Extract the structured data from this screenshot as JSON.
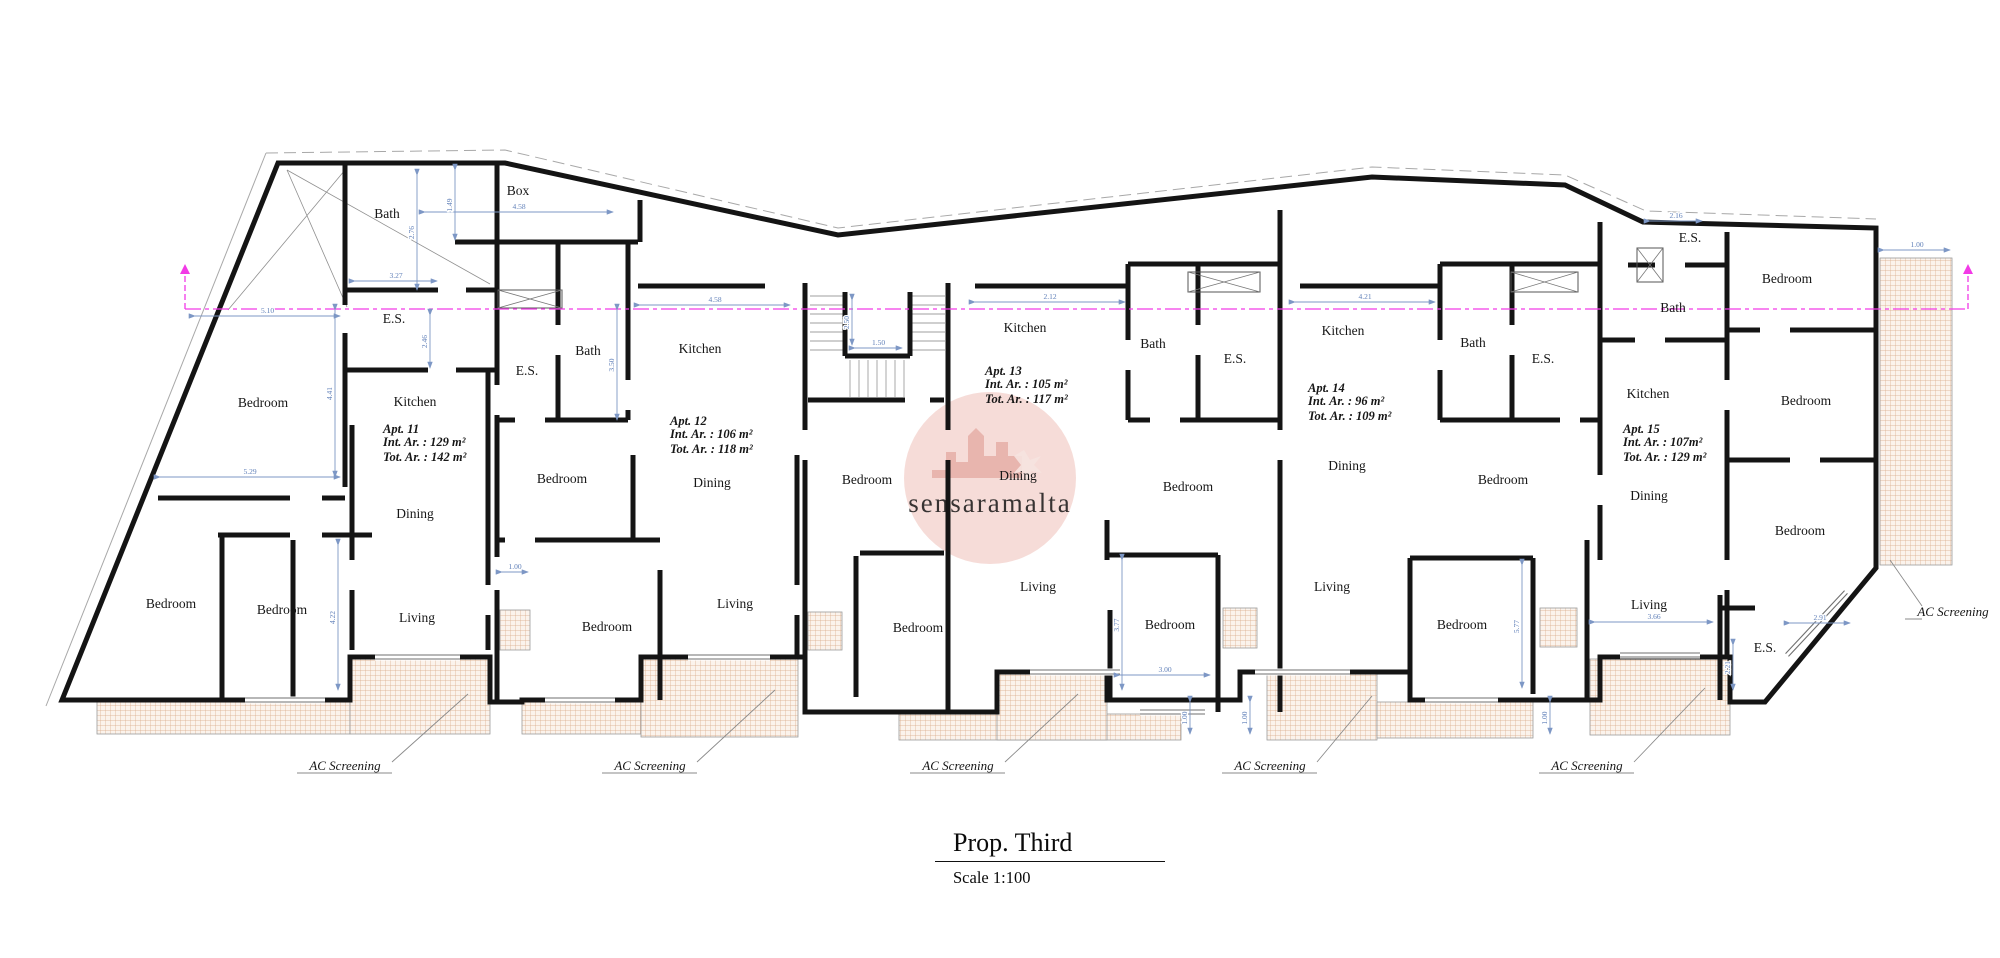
{
  "title": {
    "text": "Prop. Third",
    "scale": "Scale 1:100"
  },
  "watermark": {
    "text": "sensaramalta",
    "cx": 990,
    "cy": 478,
    "r": 86,
    "circle_color": "#f0c6c0",
    "glyph_color": "#e2a49c",
    "text_color": "#d9beb8"
  },
  "colors": {
    "wall": "#141414",
    "thin": "#9a9a9a",
    "boundary": "#a8a8a8",
    "dim": "#7d97c5",
    "dim_text": "#5f7fb8",
    "section": "#f23ae6",
    "hatch_line": "#d9a987",
    "hatch_bg": "#fbf3ec"
  },
  "envelope": "M62,700 L278,163 L505,163 L838,235 L1372,177 L1565,185 L1643,222 L1876,228 L1876,568 L1765,702 L1730,702 L1730,657 L1600,657 L1600,700 L1533,700 L1410,700 L1410,672 L1240,672 L1240,700 L1107,700 L1107,672 L997,672 L997,712 L805,712 L805,657 L641,657 L641,700 L522,700 L522,702 L490,702 L490,657 L350,657 L350,700 L62,700 Z",
  "boundary_solid": [
    [
      46,
      706,
      266,
      153
    ]
  ],
  "boundary_dashed": "M266,153 L505,150 L838,228 L1372,167 L1565,175 L1646,211 L1876,219",
  "cross_brace": [
    [
      287,
      170,
      490,
      284
    ],
    [
      287,
      170,
      347,
      307
    ],
    [
      345,
      170,
      228,
      310
    ]
  ],
  "walls": [
    [
      345,
      163,
      345,
      305
    ],
    [
      345,
      290,
      438,
      290
    ],
    [
      466,
      290,
      497,
      290
    ],
    [
      345,
      333,
      345,
      487
    ],
    [
      345,
      370,
      428,
      370
    ],
    [
      456,
      370,
      497,
      370
    ],
    [
      158,
      498,
      290,
      498
    ],
    [
      322,
      498,
      345,
      498
    ],
    [
      218,
      535,
      290,
      535
    ],
    [
      322,
      535,
      372,
      535
    ],
    [
      222,
      535,
      222,
      700
    ],
    [
      293,
      540,
      293,
      700
    ],
    [
      352,
      425,
      352,
      560
    ],
    [
      352,
      590,
      352,
      650
    ],
    [
      488,
      370,
      488,
      585
    ],
    [
      488,
      615,
      488,
      650
    ],
    [
      497,
      163,
      497,
      385
    ],
    [
      497,
      415,
      497,
      557
    ],
    [
      497,
      590,
      497,
      700
    ],
    [
      455,
      242,
      638,
      242
    ],
    [
      640,
      200,
      640,
      242
    ],
    [
      558,
      242,
      558,
      325
    ],
    [
      558,
      355,
      558,
      420
    ],
    [
      628,
      242,
      628,
      380
    ],
    [
      628,
      410,
      628,
      420
    ],
    [
      497,
      420,
      515,
      420
    ],
    [
      545,
      420,
      628,
      420
    ],
    [
      638,
      286,
      765,
      286
    ],
    [
      497,
      540,
      505,
      540
    ],
    [
      535,
      540,
      660,
      540
    ],
    [
      633,
      455,
      633,
      540
    ],
    [
      660,
      570,
      660,
      700
    ],
    [
      797,
      455,
      797,
      585
    ],
    [
      797,
      615,
      797,
      655
    ],
    [
      805,
      283,
      805,
      430
    ],
    [
      805,
      460,
      805,
      700
    ],
    [
      845,
      292,
      845,
      356
    ],
    [
      845,
      356,
      910,
      356
    ],
    [
      910,
      292,
      910,
      356
    ],
    [
      808,
      400,
      905,
      400
    ],
    [
      930,
      400,
      944,
      400
    ],
    [
      860,
      553,
      944,
      553
    ],
    [
      856,
      556,
      856,
      697
    ],
    [
      948,
      283,
      948,
      430
    ],
    [
      948,
      460,
      948,
      712
    ],
    [
      975,
      286,
      1128,
      286
    ],
    [
      1128,
      264,
      1280,
      264
    ],
    [
      1128,
      264,
      1128,
      340
    ],
    [
      1128,
      370,
      1128,
      420
    ],
    [
      1198,
      264,
      1198,
      325
    ],
    [
      1198,
      355,
      1198,
      420
    ],
    [
      1128,
      420,
      1150,
      420
    ],
    [
      1180,
      420,
      1280,
      420
    ],
    [
      1280,
      210,
      1280,
      430
    ],
    [
      1280,
      460,
      1280,
      712
    ],
    [
      1107,
      520,
      1107,
      560
    ],
    [
      1107,
      555,
      1218,
      555
    ],
    [
      1218,
      555,
      1218,
      712
    ],
    [
      1110,
      610,
      1110,
      700
    ],
    [
      1300,
      286,
      1440,
      286
    ],
    [
      1440,
      264,
      1600,
      264
    ],
    [
      1440,
      264,
      1440,
      340
    ],
    [
      1440,
      370,
      1440,
      420
    ],
    [
      1512,
      264,
      1512,
      325
    ],
    [
      1512,
      355,
      1512,
      420
    ],
    [
      1440,
      420,
      1560,
      420
    ],
    [
      1580,
      420,
      1600,
      420
    ],
    [
      1600,
      222,
      1600,
      475
    ],
    [
      1600,
      505,
      1600,
      560
    ],
    [
      1587,
      540,
      1587,
      700
    ],
    [
      1410,
      558,
      1533,
      558
    ],
    [
      1410,
      558,
      1410,
      694
    ],
    [
      1533,
      558,
      1533,
      694
    ],
    [
      1600,
      340,
      1635,
      340
    ],
    [
      1665,
      340,
      1727,
      340
    ],
    [
      1628,
      265,
      1655,
      265
    ],
    [
      1685,
      265,
      1727,
      265
    ],
    [
      1727,
      232,
      1727,
      380
    ],
    [
      1727,
      410,
      1727,
      560
    ],
    [
      1727,
      590,
      1727,
      657
    ],
    [
      1727,
      330,
      1760,
      330
    ],
    [
      1790,
      330,
      1876,
      330
    ],
    [
      1727,
      460,
      1790,
      460
    ],
    [
      1820,
      460,
      1876,
      460
    ],
    [
      1720,
      595,
      1720,
      700
    ],
    [
      1720,
      608,
      1755,
      608
    ]
  ],
  "stair_treads": [
    [
      810,
      296,
      843,
      296
    ],
    [
      810,
      305,
      843,
      305
    ],
    [
      810,
      314,
      843,
      314
    ],
    [
      810,
      323,
      843,
      323
    ],
    [
      810,
      332,
      843,
      332
    ],
    [
      810,
      341,
      843,
      341
    ],
    [
      810,
      350,
      843,
      350
    ],
    [
      912,
      296,
      945,
      296
    ],
    [
      912,
      305,
      945,
      305
    ],
    [
      912,
      314,
      945,
      314
    ],
    [
      912,
      323,
      945,
      323
    ],
    [
      912,
      332,
      945,
      332
    ],
    [
      912,
      341,
      945,
      341
    ],
    [
      912,
      350,
      945,
      350
    ],
    [
      850,
      360,
      850,
      397
    ],
    [
      859,
      360,
      859,
      397
    ],
    [
      868,
      360,
      868,
      397
    ],
    [
      877,
      360,
      877,
      397
    ],
    [
      886,
      360,
      886,
      397
    ],
    [
      895,
      360,
      895,
      397
    ],
    [
      904,
      360,
      904,
      397
    ]
  ],
  "terraces": [
    [
      97,
      702,
      253,
      32
    ],
    [
      350,
      659,
      140,
      75
    ],
    [
      522,
      702,
      119,
      32
    ],
    [
      641,
      659,
      157,
      78
    ],
    [
      899,
      714,
      282,
      26
    ],
    [
      997,
      674,
      110,
      66
    ],
    [
      1267,
      674,
      110,
      66
    ],
    [
      1377,
      702,
      156,
      36
    ],
    [
      1590,
      659,
      140,
      76
    ],
    [
      1880,
      258,
      72,
      307
    ],
    [
      500,
      610,
      30,
      40
    ],
    [
      808,
      612,
      34,
      38
    ],
    [
      1223,
      608,
      34,
      40
    ],
    [
      1540,
      608,
      37,
      39
    ]
  ],
  "windows": [
    [
      375,
      657,
      460,
      657
    ],
    [
      688,
      657,
      770,
      657
    ],
    [
      1030,
      672,
      1120,
      672
    ],
    [
      1255,
      672,
      1350,
      672
    ],
    [
      1620,
      655,
      1700,
      655
    ],
    [
      245,
      700,
      325,
      700
    ],
    [
      545,
      700,
      615,
      700
    ],
    [
      1140,
      712,
      1205,
      712
    ],
    [
      1425,
      700,
      1498,
      700
    ],
    [
      1787,
      655,
      1846,
      592
    ]
  ],
  "shafts": [
    [
      498,
      290,
      64,
      18
    ],
    [
      1188,
      272,
      72,
      20
    ],
    [
      1511,
      272,
      67,
      20
    ],
    [
      1637,
      248,
      26,
      34
    ]
  ],
  "section_line": {
    "y": 309,
    "x1": 185,
    "x2": 1968,
    "stub_top": 272
  },
  "dims": [
    {
      "x1": 355,
      "y1": 281,
      "x2": 437,
      "y2": 281,
      "label": "3.27"
    },
    {
      "x1": 425,
      "y1": 212,
      "x2": 613,
      "y2": 212,
      "label": "4.58"
    },
    {
      "x1": 640,
      "y1": 305,
      "x2": 790,
      "y2": 305,
      "label": "4.58"
    },
    {
      "x1": 975,
      "y1": 302,
      "x2": 1125,
      "y2": 302,
      "label": "2.12"
    },
    {
      "x1": 1295,
      "y1": 302,
      "x2": 1435,
      "y2": 302,
      "label": "4.21"
    },
    {
      "x1": 1650,
      "y1": 221,
      "x2": 1702,
      "y2": 221,
      "label": "2.16"
    },
    {
      "x1": 160,
      "y1": 477,
      "x2": 340,
      "y2": 477,
      "label": "5.29"
    },
    {
      "x1": 195,
      "y1": 316,
      "x2": 340,
      "y2": 316,
      "label": "5.10"
    },
    {
      "x1": 1120,
      "y1": 675,
      "x2": 1210,
      "y2": 675,
      "label": "3.00"
    },
    {
      "x1": 502,
      "y1": 572,
      "x2": 528,
      "y2": 572,
      "label": "1.00"
    },
    {
      "x1": 1595,
      "y1": 622,
      "x2": 1713,
      "y2": 622,
      "label": "3.66"
    },
    {
      "x1": 1790,
      "y1": 623,
      "x2": 1850,
      "y2": 623,
      "label": "2.91"
    },
    {
      "x1": 1884,
      "y1": 250,
      "x2": 1950,
      "y2": 250,
      "label": "1.00"
    },
    {
      "x1": 855,
      "y1": 348,
      "x2": 902,
      "y2": 348,
      "label": "1.50"
    },
    {
      "x1": 417,
      "y1": 175,
      "x2": 417,
      "y2": 290,
      "label": "2.76"
    },
    {
      "x1": 455,
      "y1": 170,
      "x2": 455,
      "y2": 240,
      "label": "1.49"
    },
    {
      "x1": 430,
      "y1": 315,
      "x2": 430,
      "y2": 368,
      "label": "2.46"
    },
    {
      "x1": 335,
      "y1": 310,
      "x2": 335,
      "y2": 477,
      "label": "4.41"
    },
    {
      "x1": 338,
      "y1": 545,
      "x2": 338,
      "y2": 690,
      "label": "4.22"
    },
    {
      "x1": 617,
      "y1": 310,
      "x2": 617,
      "y2": 420,
      "label": "3.50"
    },
    {
      "x1": 852,
      "y1": 300,
      "x2": 852,
      "y2": 345,
      "label": "2.50"
    },
    {
      "x1": 1122,
      "y1": 560,
      "x2": 1122,
      "y2": 690,
      "label": "3.77"
    },
    {
      "x1": 1522,
      "y1": 565,
      "x2": 1522,
      "y2": 688,
      "label": "5.77"
    },
    {
      "x1": 1190,
      "y1": 702,
      "x2": 1190,
      "y2": 734,
      "label": "1.00"
    },
    {
      "x1": 1250,
      "y1": 702,
      "x2": 1250,
      "y2": 734,
      "label": "1.00"
    },
    {
      "x1": 1550,
      "y1": 702,
      "x2": 1550,
      "y2": 734,
      "label": "1.00"
    },
    {
      "x1": 1733,
      "y1": 645,
      "x2": 1733,
      "y2": 690,
      "label": "2.21"
    }
  ],
  "room_labels": [
    {
      "text": "Bath",
      "x": 387,
      "y": 218
    },
    {
      "text": "Bath",
      "x": 588,
      "y": 355
    },
    {
      "text": "Bath",
      "x": 1153,
      "y": 348
    },
    {
      "text": "Bath",
      "x": 1473,
      "y": 347
    },
    {
      "text": "Bath",
      "x": 1673,
      "y": 312
    },
    {
      "text": "Box",
      "x": 518,
      "y": 195
    },
    {
      "text": "E.S.",
      "x": 394,
      "y": 323
    },
    {
      "text": "E.S.",
      "x": 527,
      "y": 375
    },
    {
      "text": "E.S.",
      "x": 1235,
      "y": 363
    },
    {
      "text": "E.S.",
      "x": 1543,
      "y": 363
    },
    {
      "text": "E.S.",
      "x": 1690,
      "y": 242
    },
    {
      "text": "E.S.",
      "x": 1765,
      "y": 652
    },
    {
      "text": "Bedroom",
      "x": 263,
      "y": 407
    },
    {
      "text": "Bedroom",
      "x": 171,
      "y": 608
    },
    {
      "text": "Bedroom",
      "x": 282,
      "y": 614
    },
    {
      "text": "Bedroom",
      "x": 562,
      "y": 483
    },
    {
      "text": "Bedroom",
      "x": 607,
      "y": 631
    },
    {
      "text": "Bedroom",
      "x": 867,
      "y": 484
    },
    {
      "text": "Bedroom",
      "x": 918,
      "y": 632
    },
    {
      "text": "Bedroom",
      "x": 1188,
      "y": 491
    },
    {
      "text": "Bedroom",
      "x": 1170,
      "y": 629
    },
    {
      "text": "Bedroom",
      "x": 1503,
      "y": 484
    },
    {
      "text": "Bedroom",
      "x": 1462,
      "y": 629
    },
    {
      "text": "Bedroom",
      "x": 1787,
      "y": 283
    },
    {
      "text": "Bedroom",
      "x": 1806,
      "y": 405
    },
    {
      "text": "Bedroom",
      "x": 1800,
      "y": 535
    },
    {
      "text": "Kitchen",
      "x": 415,
      "y": 406
    },
    {
      "text": "Kitchen",
      "x": 700,
      "y": 353
    },
    {
      "text": "Kitchen",
      "x": 1025,
      "y": 332
    },
    {
      "text": "Kitchen",
      "x": 1343,
      "y": 335
    },
    {
      "text": "Kitchen",
      "x": 1648,
      "y": 398
    },
    {
      "text": "Dining",
      "x": 415,
      "y": 518
    },
    {
      "text": "Dining",
      "x": 712,
      "y": 487
    },
    {
      "text": "Dining",
      "x": 1018,
      "y": 480
    },
    {
      "text": "Dining",
      "x": 1347,
      "y": 470
    },
    {
      "text": "Dining",
      "x": 1649,
      "y": 500
    },
    {
      "text": "Living",
      "x": 417,
      "y": 622
    },
    {
      "text": "Living",
      "x": 735,
      "y": 608
    },
    {
      "text": "Living",
      "x": 1038,
      "y": 591
    },
    {
      "text": "Living",
      "x": 1332,
      "y": 591
    },
    {
      "text": "Living",
      "x": 1649,
      "y": 609
    }
  ],
  "apartments": [
    {
      "name": "Apt. 11",
      "int": "Int. Ar. : 129 m²",
      "tot": "Tot. Ar. : 142 m²",
      "x": 383,
      "y": 433
    },
    {
      "name": "Apt. 12",
      "int": "Int. Ar. : 106 m²",
      "tot": "Tot. Ar. : 118 m²",
      "x": 670,
      "y": 425
    },
    {
      "name": "Apt. 13",
      "int": "Int. Ar. : 105 m²",
      "tot": "Tot. Ar. : 117 m²",
      "x": 985,
      "y": 375
    },
    {
      "name": "Apt. 14",
      "int": "Int. Ar. : 96 m²",
      "tot": "Tot. Ar. : 109 m²",
      "x": 1308,
      "y": 392
    },
    {
      "name": "Apt. 15",
      "int": "Int. Ar. : 107m²",
      "tot": "Tot. Ar. : 129 m²",
      "x": 1623,
      "y": 433
    }
  ],
  "ac_labels": [
    {
      "text": "AC Screening",
      "x": 345,
      "y": 770,
      "lx1": 392,
      "ly1": 762,
      "lx2": 468,
      "ly2": 694
    },
    {
      "text": "AC Screening",
      "x": 650,
      "y": 770,
      "lx1": 697,
      "ly1": 762,
      "lx2": 775,
      "ly2": 690
    },
    {
      "text": "AC Screening",
      "x": 958,
      "y": 770,
      "lx1": 1005,
      "ly1": 762,
      "lx2": 1078,
      "ly2": 694
    },
    {
      "text": "AC Screening",
      "x": 1270,
      "y": 770,
      "lx1": 1317,
      "ly1": 762,
      "lx2": 1372,
      "ly2": 696
    },
    {
      "text": "AC Screening",
      "x": 1587,
      "y": 770,
      "lx1": 1634,
      "ly1": 762,
      "lx2": 1705,
      "ly2": 688
    },
    {
      "text": "AC Screening",
      "x": 1953,
      "y": 616,
      "lx1": 1922,
      "ly1": 606,
      "lx2": 1890,
      "ly2": 560
    }
  ]
}
